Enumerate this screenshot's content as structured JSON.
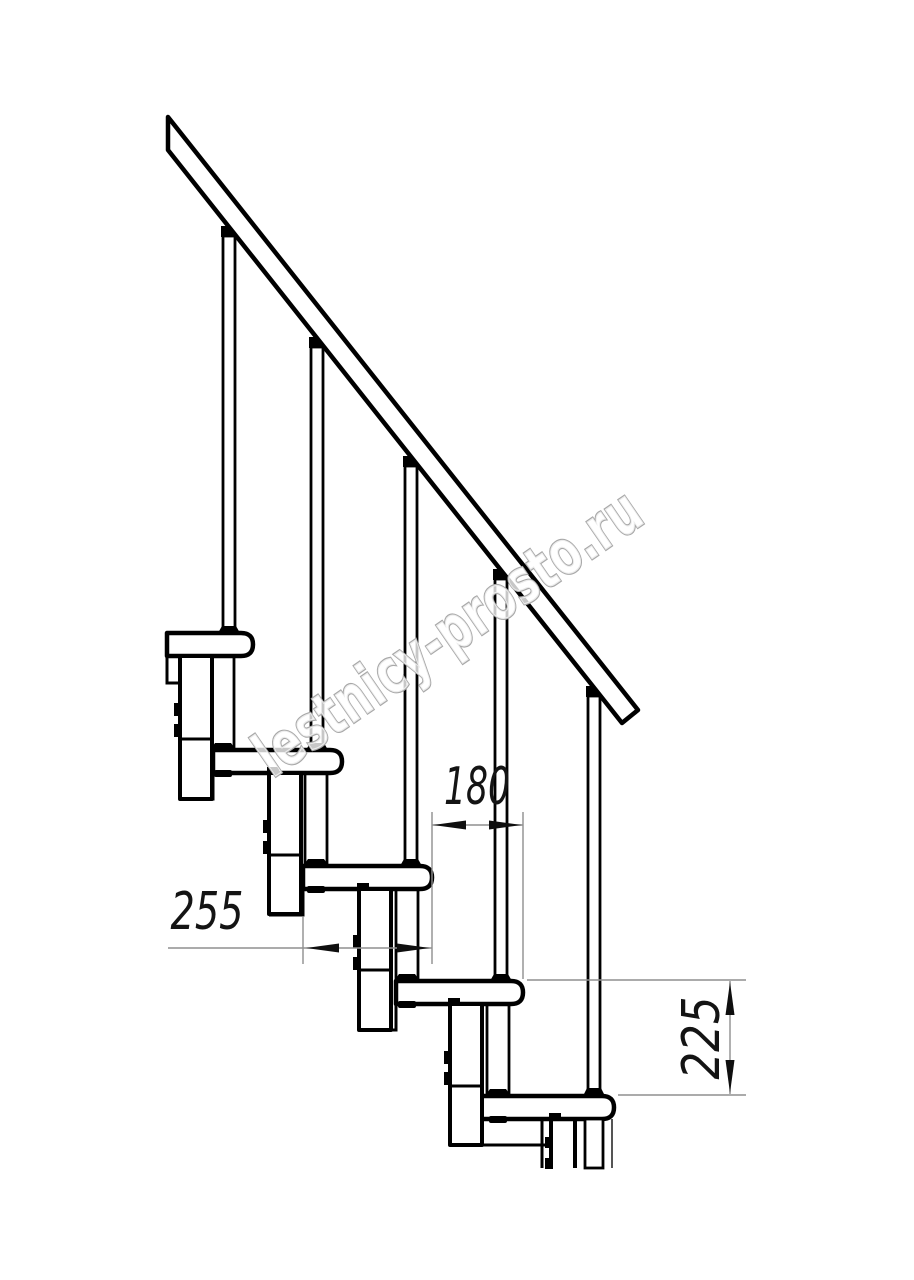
{
  "drawing": {
    "kind": "staircase-side-view",
    "watermark": {
      "text": "lestnicy-prosto.ru"
    },
    "dimensions": {
      "step_overlap_horizontal": {
        "value": "180",
        "orientation": "horizontal"
      },
      "tread_depth_horizontal": {
        "value": "255",
        "orientation": "horizontal"
      },
      "step_rise_vertical": {
        "value": "225",
        "orientation": "vertical"
      }
    },
    "colors": {
      "line": "#000000",
      "background": "#ffffff",
      "dimension_line": "#8f8f8f",
      "dimension_text": "#141414",
      "watermark_outline": "#a8a8a8",
      "watermark_fill": "#ffffff"
    }
  }
}
